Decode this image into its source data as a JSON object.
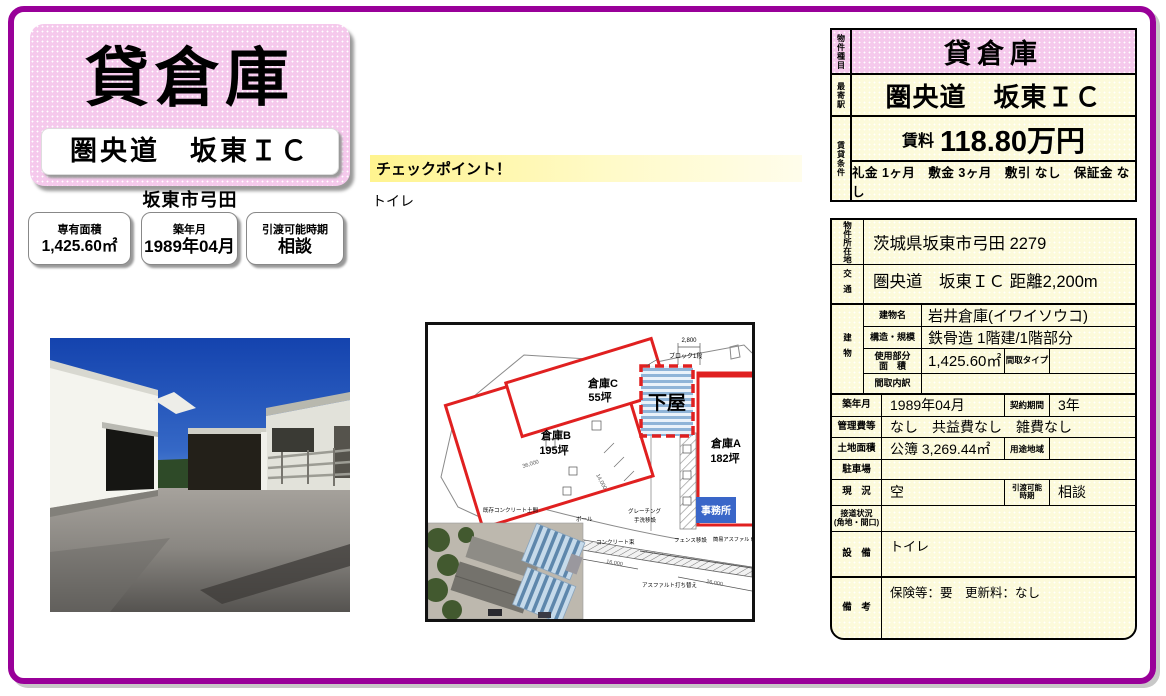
{
  "colors": {
    "frame_magenta": "#990099",
    "pink": "#F5C9EC",
    "cream": "#FCFADB",
    "plan_red": "#E02020",
    "office_blue": "#3A66C8",
    "checkpoint_yellow": "#FFF48F"
  },
  "hero": {
    "title": "貸倉庫",
    "subtitle": "圏央道　坂東ＩＣ",
    "city": "坂東市弓田"
  },
  "info_boxes": [
    {
      "label": "専有面積",
      "value": "1,425.60㎡"
    },
    {
      "label": "築年月",
      "value": "1989年04月"
    },
    {
      "label": "引渡可能時期",
      "value": "相談"
    }
  ],
  "checkpoint": {
    "heading": "チェックポイント！",
    "note": "トイレ"
  },
  "summary": {
    "type_label": "物件種目",
    "type_value": "貸倉庫",
    "station_label": "最寄駅",
    "station_value": "圏央道　坂東ＩＣ",
    "terms_label": "賃貸条件",
    "rent_label": "賃料",
    "rent_value": "118.80万円",
    "terms_detail": "礼金 1ヶ月　敷金 3ヶ月　敷引 なし　保証金 なし"
  },
  "details": {
    "address_label": "物件所在地",
    "address": "茨城県坂東市弓田 2279",
    "access_label": "交通",
    "access": "圏央道　坂東ＩＣ 距離2,200m",
    "building_label": "建物",
    "building_name_label": "建物名",
    "building_name": "岩井倉庫(イワイソウコ)",
    "structure_label": "構造・規模",
    "structure": "鉄骨造 1階建/1階部分",
    "used_area_label1": "使用部分",
    "used_area_label2": "面　積",
    "used_area": "1,425.60㎡",
    "madori_type_label": "間取タイプ",
    "madori_type": "",
    "madori_detail_label": "間取内訳",
    "madori_detail": "",
    "built_label": "築年月",
    "built": "1989年04月",
    "contract_label": "契約期間",
    "contract": "3年",
    "mgmt_label": "管理費等",
    "mgmt": "なし　共益費なし　雑費なし",
    "land_label": "土地面積",
    "land": "公簿 3,269.44㎡",
    "zoning_label": "用途地域",
    "zoning": "",
    "parking_label": "駐車場",
    "parking": "",
    "status_label": "現　況",
    "status": "空",
    "handover_label1": "引渡可能",
    "handover_label2": "時期",
    "handover": "相談",
    "road_label1": "接道状況",
    "road_label2": "(角地・間口)",
    "road": "",
    "equip_label": "設　備",
    "equip": "トイレ",
    "remarks_label": "備　考",
    "remarks": "保険等：要　更新料：なし"
  },
  "site_plan": {
    "warehouse_c": "倉庫C",
    "warehouse_c_area": "55坪",
    "warehouse_b": "倉庫B",
    "warehouse_b_area": "195坪",
    "warehouse_a": "倉庫A",
    "warehouse_a_area": "182坪",
    "geya": "下屋",
    "office": "事務所",
    "block_label": "ブロック1段",
    "dim_2800": "2,800",
    "dim_36000": "36,000",
    "dim_14000": "14,000",
    "dim_16000": "16,000",
    "dim_26000": "26,000",
    "lbl_existing_concrete": "既存コンクリート土間",
    "lbl_pole": "ポール",
    "lbl_grating": "グレーチング",
    "lbl_tearai": "手洗移設",
    "lbl_concrete": "コンクリート束",
    "lbl_fence": "フェンス移設",
    "lbl_simple_asphalt": "簡易アスファルト舗装",
    "lbl_asphalt": "アスファルト打ち替え"
  }
}
